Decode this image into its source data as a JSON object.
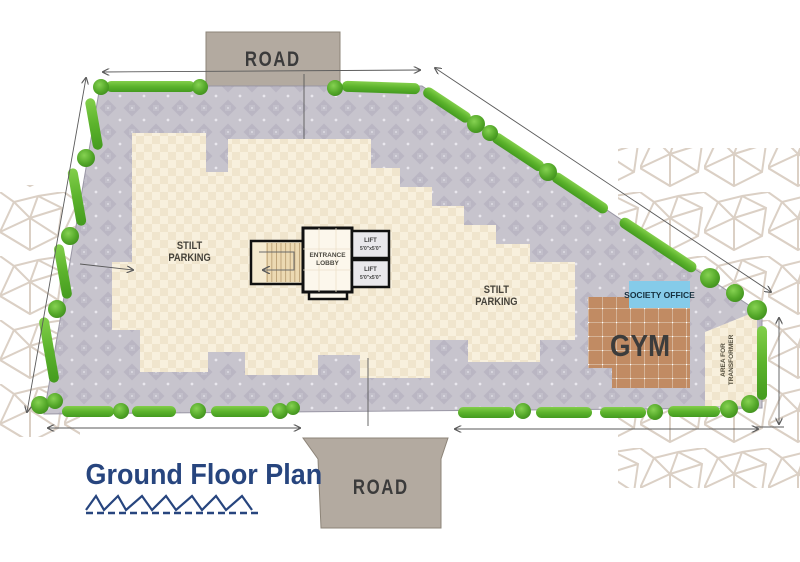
{
  "title": {
    "text": "Ground Floor Plan"
  },
  "roads": {
    "top": "ROAD",
    "bottom": "ROAD"
  },
  "areas": {
    "stilt_left": {
      "l1": "STILT",
      "l2": "PARKING"
    },
    "stilt_right": {
      "l1": "STILT",
      "l2": "PARKING"
    },
    "gym": "GYM",
    "society": "SOCIETY OFFICE",
    "transformer": {
      "l1": "AREA FOR",
      "l2": "TRANSFORMER"
    }
  },
  "core": {
    "lobby": {
      "l1": "ENTRANCE",
      "l2": "LOBBY"
    },
    "lift_top": {
      "name": "LIFT",
      "size": "5'0\"x5'0\""
    },
    "lift_bottom": {
      "name": "LIFT",
      "size": "5'0\"x5'0\""
    }
  },
  "colors": {
    "paving": "#c7c4cd",
    "building": "#f8f0dd",
    "hedge": "#5cb32c",
    "gym": "#c18b63",
    "society_office": "#85cbe9",
    "road": "#b3aaa0",
    "title": "#27457e",
    "walls": "#111111"
  }
}
